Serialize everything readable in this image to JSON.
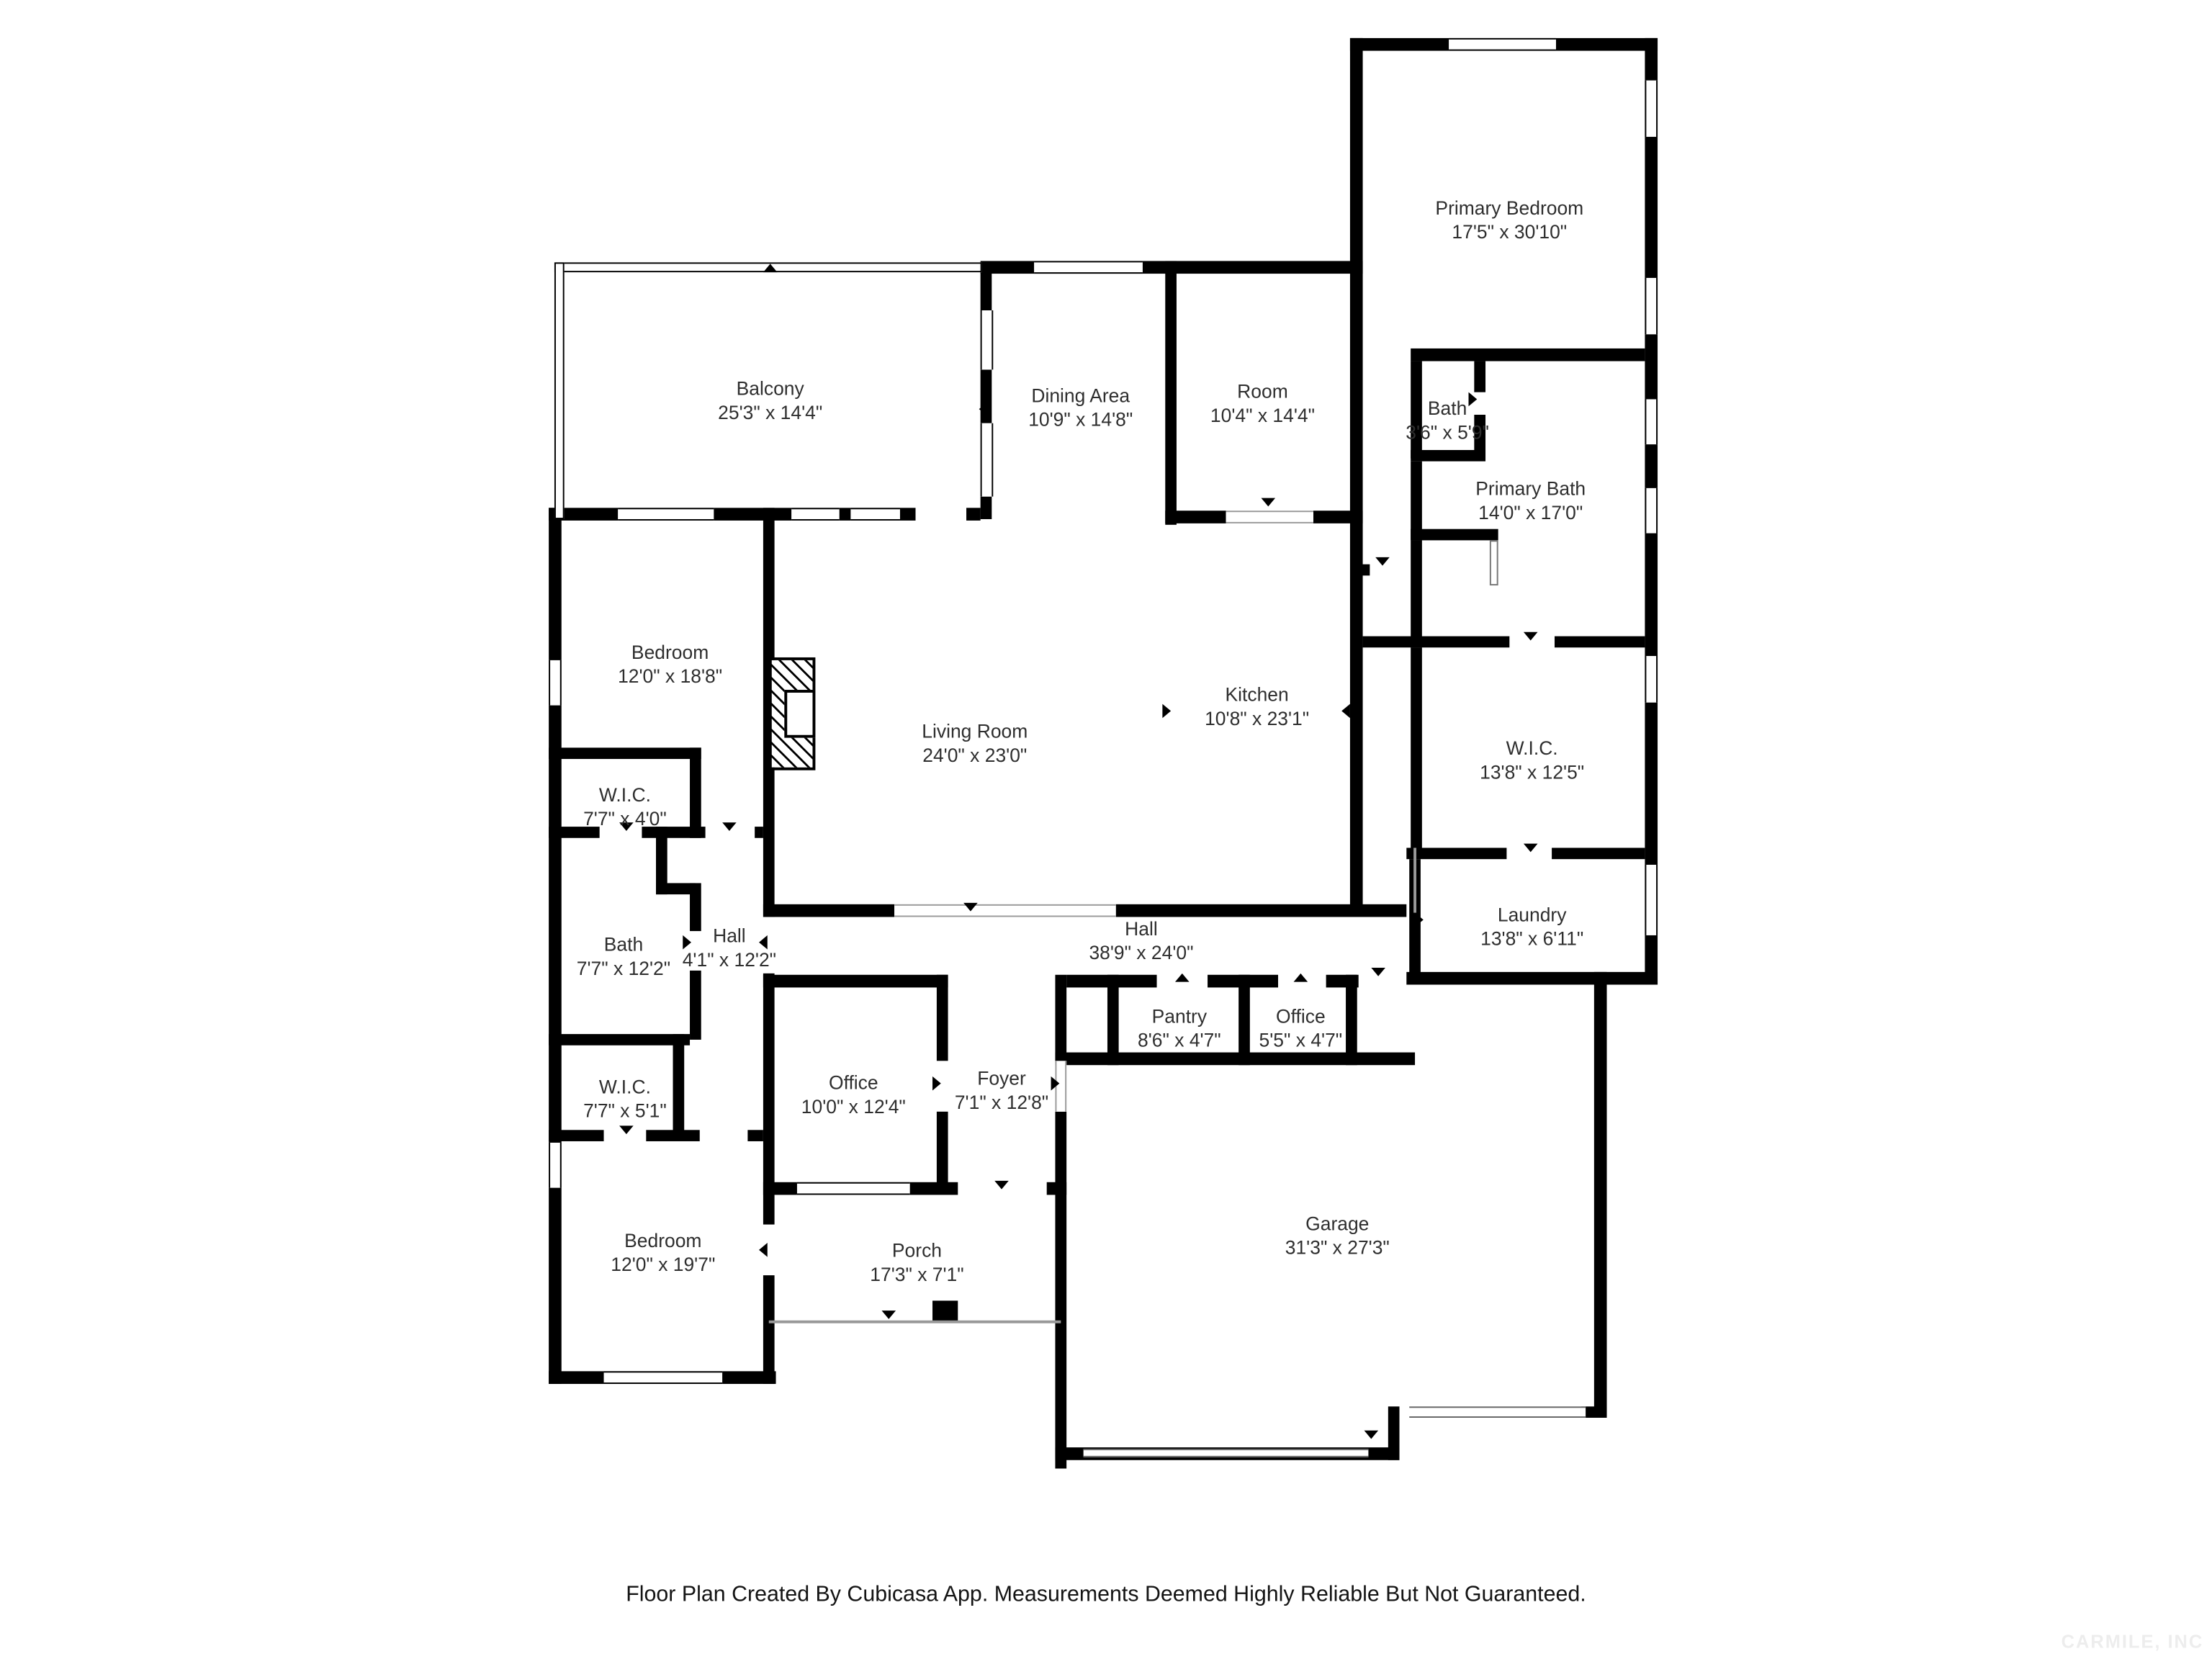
{
  "rooms": [
    {
      "name": "Primary Bedroom",
      "dims": "17'5\" x 30'10\""
    },
    {
      "name": "Balcony",
      "dims": "25'3\" x 14'4\""
    },
    {
      "name": "Dining Area",
      "dims": "10'9\" x 14'8\""
    },
    {
      "name": "Room",
      "dims": "10'4\" x 14'4\""
    },
    {
      "name": "Bath",
      "dims": "3'6\" x 5'9\""
    },
    {
      "name": "Primary Bath",
      "dims": "14'0\" x 17'0\""
    },
    {
      "name": "Bedroom",
      "dims": "12'0\" x 18'8\""
    },
    {
      "name": "Living Room",
      "dims": "24'0\" x 23'0\""
    },
    {
      "name": "Kitchen",
      "dims": "10'8\" x 23'1\""
    },
    {
      "name": "W.I.C.",
      "dims": "13'8\" x 12'5\""
    },
    {
      "name": "W.I.C.",
      "dims": "7'7\" x 4'0\""
    },
    {
      "name": "Bath",
      "dims": "7'7\" x 12'2\""
    },
    {
      "name": "Hall",
      "dims": "4'1\" x 12'2\""
    },
    {
      "name": "Hall",
      "dims": "38'9\" x 24'0\""
    },
    {
      "name": "Laundry",
      "dims": "13'8\" x 6'11\""
    },
    {
      "name": "W.I.C.",
      "dims": "7'7\" x 5'1\""
    },
    {
      "name": "Pantry",
      "dims": "8'6\" x 4'7\""
    },
    {
      "name": "Office",
      "dims": "5'5\" x 4'7\""
    },
    {
      "name": "Office",
      "dims": "10'0\" x 12'4\""
    },
    {
      "name": "Foyer",
      "dims": "7'1\" x 12'8\""
    },
    {
      "name": "Bedroom",
      "dims": "12'0\" x 19'7\""
    },
    {
      "name": "Porch",
      "dims": "17'3\" x 7'1\""
    },
    {
      "name": "Garage",
      "dims": "31'3\" x 27'3\""
    }
  ],
  "footer": {
    "text": "Floor Plan Created By Cubicasa App. Measurements Deemed Highly Reliable But Not Guaranteed."
  },
  "watermark": {
    "text": "CARMILE, INC"
  },
  "colors": {
    "wall": "#000000",
    "background": "#ffffff",
    "label_text": "#2e2e2e",
    "opening_line": "#9a9a9a",
    "watermark_text": "#ededed"
  }
}
